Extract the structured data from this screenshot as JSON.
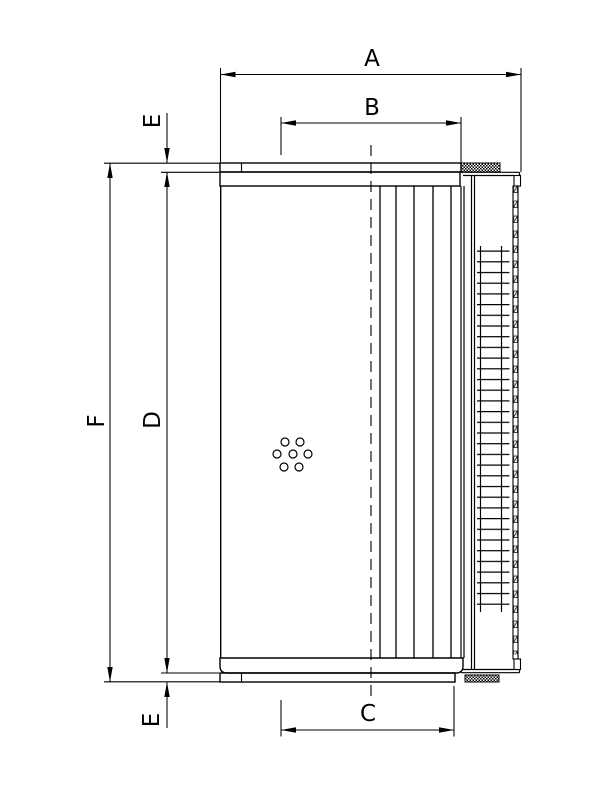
{
  "drawing": {
    "background_color": "#ffffff",
    "line_color": "#000000",
    "dimensions": {
      "A": {
        "label": "A"
      },
      "B": {
        "label": "B"
      },
      "C": {
        "label": "C"
      },
      "D": {
        "label": "D"
      },
      "E_top": {
        "label": "E"
      },
      "E_bottom": {
        "label": "E"
      },
      "F": {
        "label": "F"
      }
    }
  }
}
